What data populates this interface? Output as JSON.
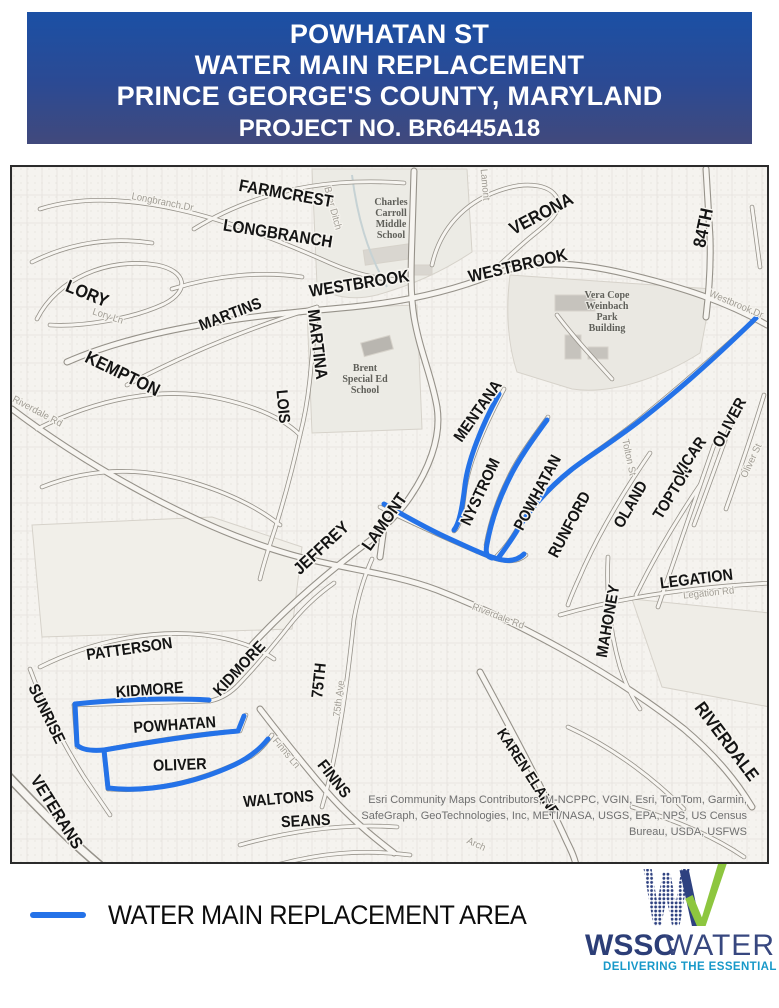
{
  "header": {
    "line1": "POWHATAN ST",
    "line2": "WATER MAIN REPLACEMENT",
    "line3": "PRINCE GEORGE'S COUNTY, MARYLAND",
    "project_no": "PROJECT NO. BR6445A18",
    "bg_top": "#1b50a5",
    "bg_bottom": "#41497c",
    "text_color": "#ffffff"
  },
  "legend": {
    "label": "WATER MAIN REPLACEMENT AREA",
    "line_color": "#2472e8"
  },
  "logo": {
    "wssc": "WSSC",
    "water": "WATER",
    "tagline": "DELIVERING THE ESSENTIAL",
    "navy": "#2e4180",
    "green": "#8dc63f",
    "teal": "#1899c9"
  },
  "map": {
    "colors": {
      "water_main": "#2472e8",
      "label": "#141414",
      "minor_label": "#a19d95"
    },
    "street_labels": [
      {
        "t": "FARMCREST",
        "x": 273,
        "y": 32,
        "r": 10,
        "s": 17
      },
      {
        "t": "LONGBRANCH",
        "x": 265,
        "y": 72,
        "r": 9,
        "s": 17
      },
      {
        "t": "VERONA",
        "x": 532,
        "y": 52,
        "r": -28,
        "s": 18
      },
      {
        "t": "84TH",
        "x": 697,
        "y": 62,
        "r": -78,
        "s": 18
      },
      {
        "t": "WESTBROOK",
        "x": 348,
        "y": 122,
        "r": -9,
        "s": 17
      },
      {
        "t": "WESTBROOK",
        "x": 507,
        "y": 104,
        "r": -13,
        "s": 17
      },
      {
        "t": "LORY",
        "x": 73,
        "y": 132,
        "r": 22,
        "s": 18
      },
      {
        "t": "MARTINS",
        "x": 220,
        "y": 152,
        "r": -21,
        "s": 16
      },
      {
        "t": "MARTINA",
        "x": 300,
        "y": 178,
        "r": 83,
        "s": 17
      },
      {
        "t": "KEMPTON",
        "x": 108,
        "y": 212,
        "r": 26,
        "s": 18
      },
      {
        "t": "LOIS",
        "x": 266,
        "y": 240,
        "r": 85,
        "s": 16
      },
      {
        "t": "MENTANA",
        "x": 470,
        "y": 247,
        "r": -55,
        "s": 16
      },
      {
        "t": "NYSTROM",
        "x": 473,
        "y": 327,
        "r": -65,
        "s": 16
      },
      {
        "t": "POWHATAN",
        "x": 530,
        "y": 328,
        "r": -62,
        "s": 16
      },
      {
        "t": "RUNFORD",
        "x": 562,
        "y": 360,
        "r": -62,
        "s": 16
      },
      {
        "t": "OLAND",
        "x": 623,
        "y": 340,
        "r": -60,
        "s": 16
      },
      {
        "t": "TOPTON",
        "x": 665,
        "y": 328,
        "r": -58,
        "s": 16
      },
      {
        "t": "VICAR",
        "x": 682,
        "y": 293,
        "r": -55,
        "s": 16
      },
      {
        "t": "OLIVER",
        "x": 722,
        "y": 258,
        "r": -62,
        "s": 16
      },
      {
        "t": "LAMONT",
        "x": 377,
        "y": 358,
        "r": -55,
        "s": 17
      },
      {
        "t": "JEFFREY",
        "x": 313,
        "y": 385,
        "r": -43,
        "s": 17
      },
      {
        "t": "LEGATION",
        "x": 685,
        "y": 417,
        "r": -7,
        "s": 16
      },
      {
        "t": "MAHONEY",
        "x": 601,
        "y": 455,
        "r": -80,
        "s": 16
      },
      {
        "t": "KAREN ELAINE",
        "x": 512,
        "y": 608,
        "r": 57,
        "s": 15
      },
      {
        "t": "RIVERDALE",
        "x": 710,
        "y": 578,
        "r": 53,
        "s": 18
      },
      {
        "t": "PATTERSON",
        "x": 118,
        "y": 487,
        "r": -8,
        "s": 16
      },
      {
        "t": "SUNRISE",
        "x": 30,
        "y": 549,
        "r": 64,
        "s": 16
      },
      {
        "t": "KIDMORE",
        "x": 138,
        "y": 528,
        "r": -4,
        "s": 16
      },
      {
        "t": "KIDMORE",
        "x": 231,
        "y": 505,
        "r": -47,
        "s": 16
      },
      {
        "t": "POWHATAN",
        "x": 163,
        "y": 563,
        "r": -4,
        "s": 16
      },
      {
        "t": "OLIVER",
        "x": 168,
        "y": 603,
        "r": -2,
        "s": 16
      },
      {
        "t": "VETERANS",
        "x": 40,
        "y": 648,
        "r": 58,
        "s": 17
      },
      {
        "t": "75TH",
        "x": 312,
        "y": 514,
        "r": -84,
        "s": 16
      },
      {
        "t": "FINNS",
        "x": 318,
        "y": 615,
        "r": 52,
        "s": 16
      },
      {
        "t": "WALTONS",
        "x": 267,
        "y": 637,
        "r": -5,
        "s": 16
      },
      {
        "t": "SEANS",
        "x": 294,
        "y": 659,
        "r": -3,
        "s": 16
      }
    ],
    "minor_labels": [
      {
        "t": "Longbranch Dr",
        "x": 150,
        "y": 38,
        "r": 11
      },
      {
        "t": "Brier Ditch",
        "x": 318,
        "y": 42,
        "r": 75
      },
      {
        "t": "Lamont",
        "x": 470,
        "y": 18,
        "r": 85
      },
      {
        "t": "Westbrook Dr",
        "x": 723,
        "y": 140,
        "r": 23
      },
      {
        "t": "Oliver St",
        "x": 742,
        "y": 295,
        "r": -65
      },
      {
        "t": "Lory Ln",
        "x": 95,
        "y": 152,
        "r": 18
      },
      {
        "t": "Tolton St",
        "x": 614,
        "y": 291,
        "r": 78
      },
      {
        "t": "Riverdale Rd",
        "x": 485,
        "y": 452,
        "r": 21
      },
      {
        "t": "Riverdale Rd",
        "x": 24,
        "y": 247,
        "r": 28
      },
      {
        "t": "Legation Rd",
        "x": 697,
        "y": 429,
        "r": -6
      },
      {
        "t": "Finns Ln",
        "x": 272,
        "y": 588,
        "r": 50
      },
      {
        "t": "75th Ave",
        "x": 330,
        "y": 532,
        "r": -83
      },
      {
        "t": "Arch",
        "x": 463,
        "y": 680,
        "r": 25
      }
    ],
    "area_labels": [
      {
        "lines": [
          "Charles",
          "Carroll",
          "Middle",
          "School"
        ],
        "x": 379,
        "y": 38
      },
      {
        "lines": [
          "Brent",
          "Special Ed",
          "School"
        ],
        "x": 353,
        "y": 204
      },
      {
        "lines": [
          "Vera Cope",
          "Weinbach",
          "Park",
          "Building"
        ],
        "x": 595,
        "y": 131
      }
    ],
    "water_lines": [
      "M 372,337 C 398,352 420,364 438,372 C 458,381 472,388 486,392 C 497,395 506,393 512,387",
      "M 487,227 C 470,258 456,293 453,318 C 450,343 447,357 442,363",
      "M 535,253 C 521,272 506,293 497,312 C 487,332 479,355 475,377 C 473,386 475,390 480,391",
      "M 745,150 C 702,192 662,227 630,252 C 599,276 574,291 559,303 C 535,322 516,345 506,362 C 499,374 492,383 487,390",
      "M 63,537 C 110,532 160,531 197,533",
      "M 63,537 L 65,578 C 70,583 80,584 92,583",
      "M 92,583 C 138,575 190,567 226,564 L 232,549",
      "M 92,583 L 96,621",
      "M 96,621 C 140,626 185,615 222,598 C 237,591 248,582 256,572"
    ],
    "attribution": {
      "x": 735,
      "lines": [
        {
          "t": "Esri Community Maps Contributors, M-NCPPC, VGIN, Esri, TomTom, Garmin,",
          "y": 636
        },
        {
          "t": "SafeGraph, GeoTechnologies, Inc, METI/NASA, USGS, EPA, NPS, US Census",
          "y": 652
        },
        {
          "t": "Bureau, USDA, USFWS",
          "y": 668
        }
      ]
    }
  }
}
